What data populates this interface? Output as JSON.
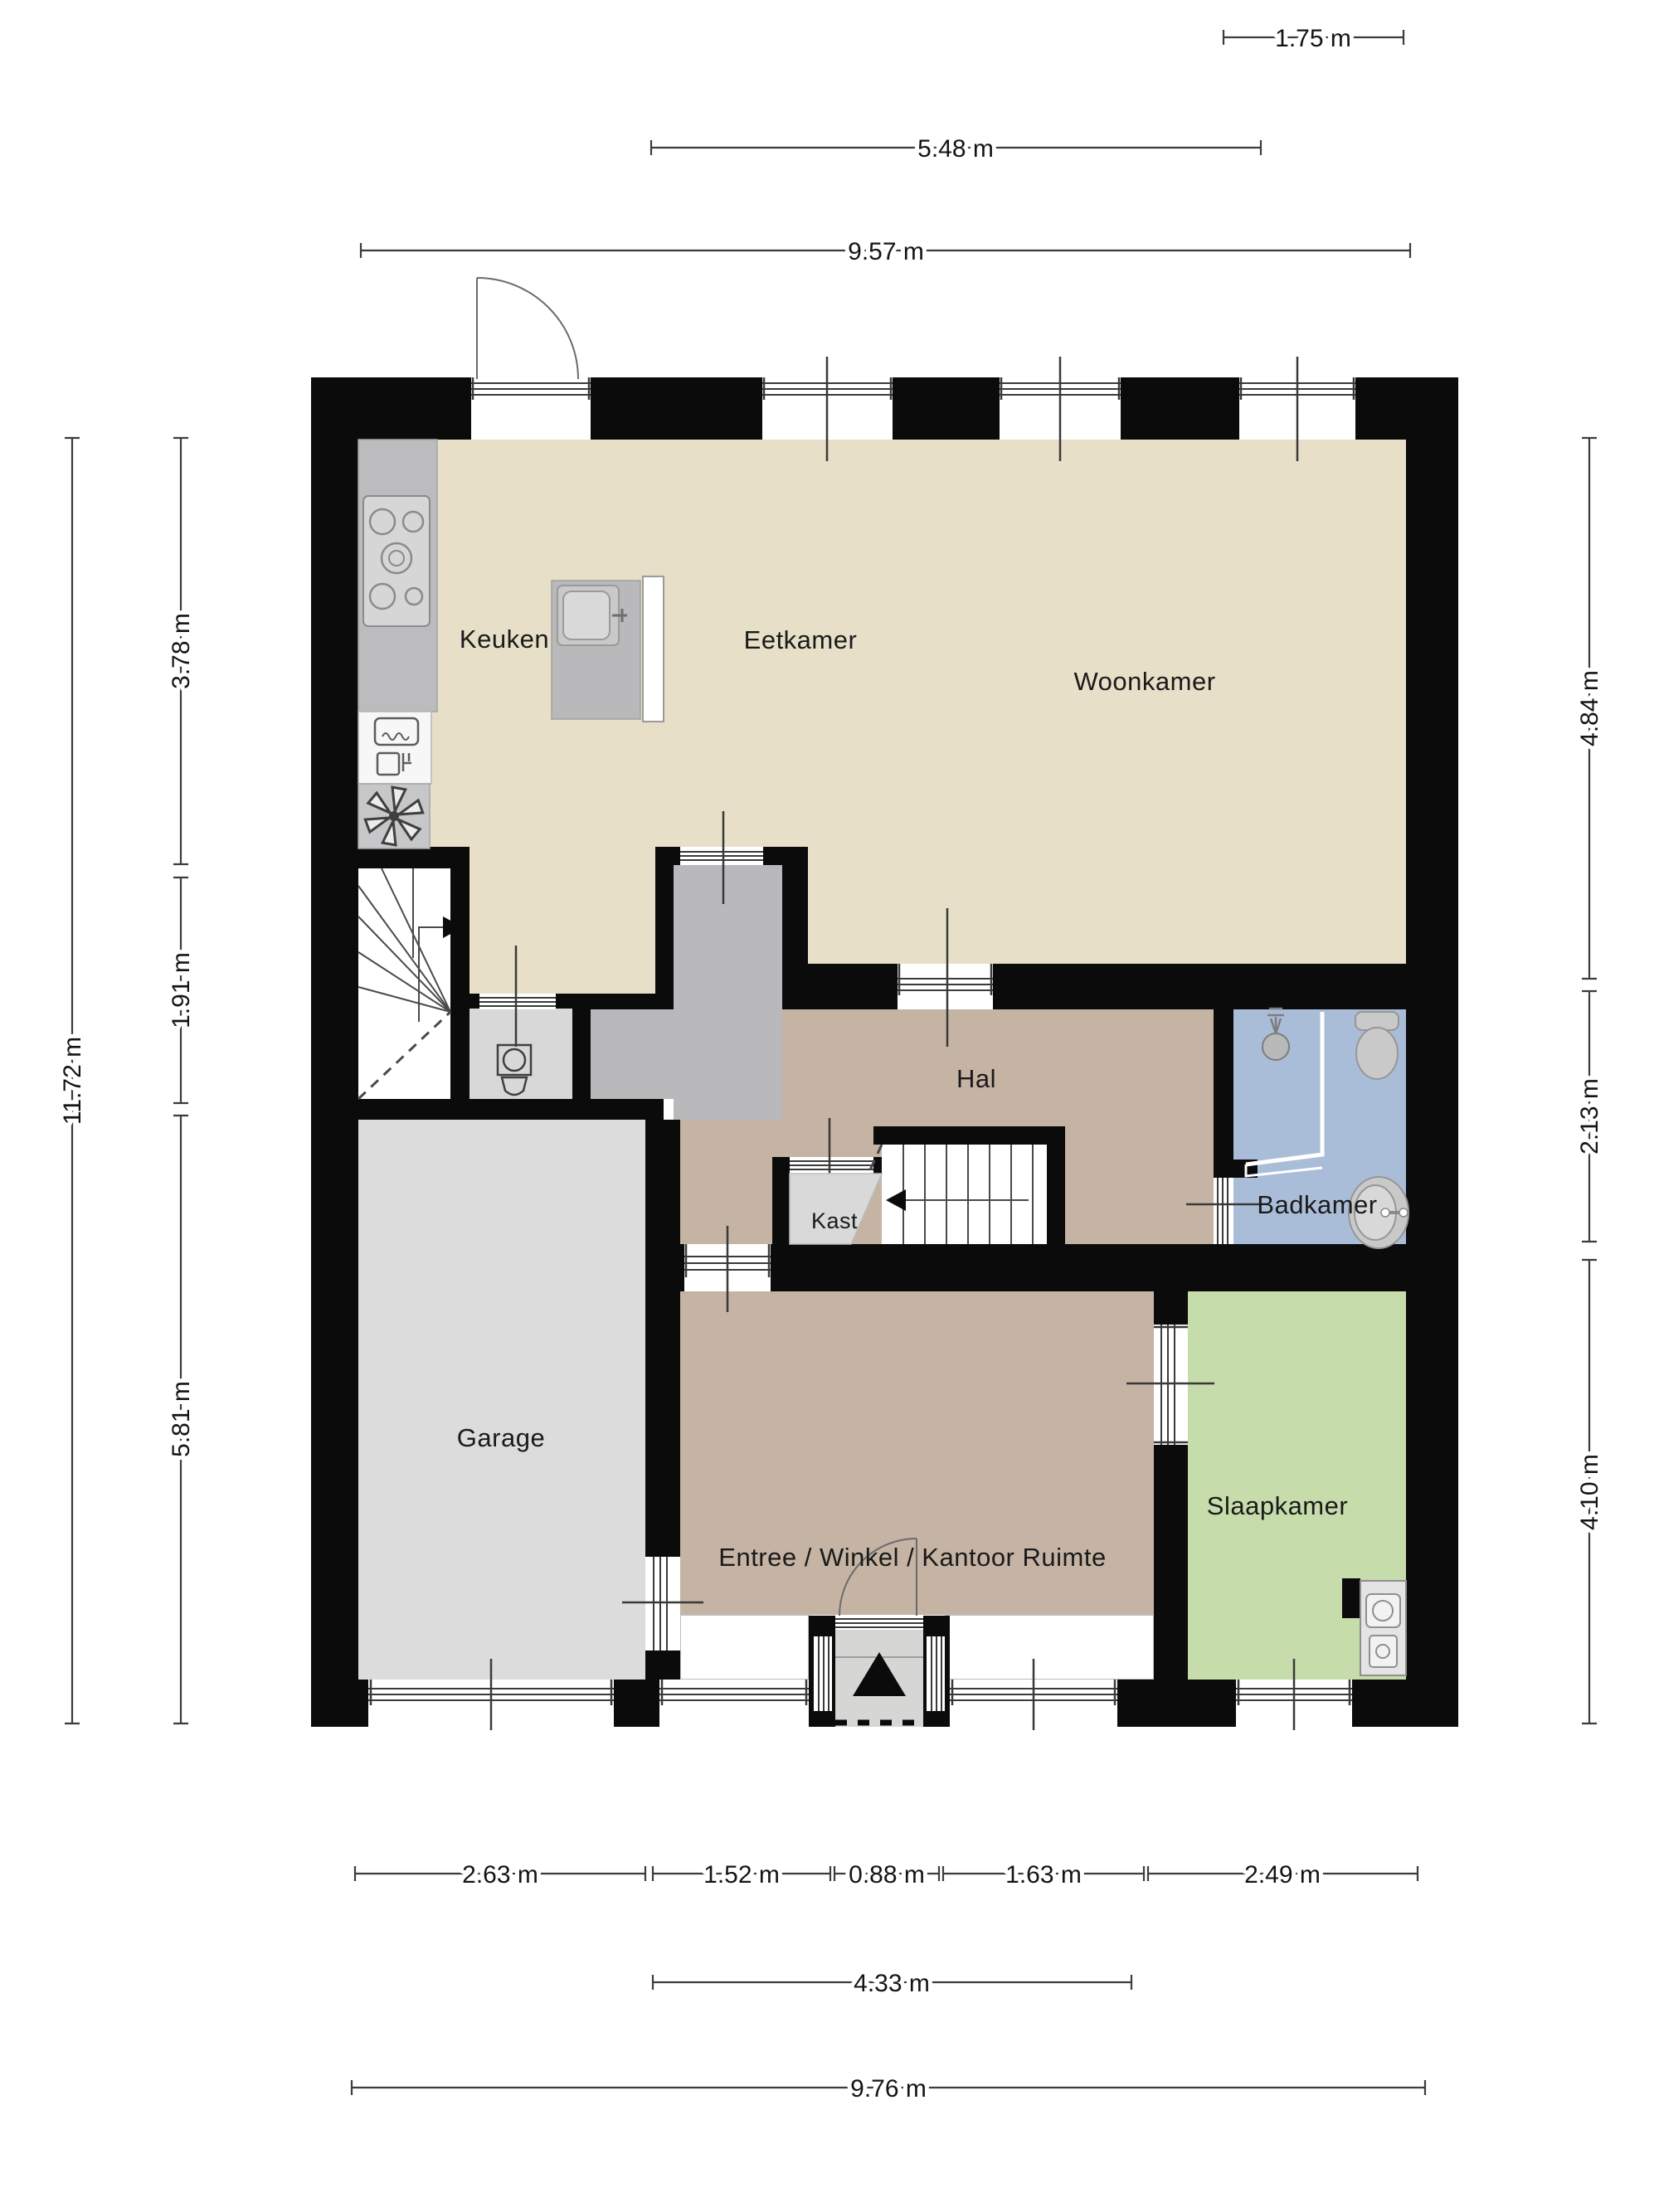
{
  "floorplan": {
    "title": "Begane grond plattegrond",
    "rooms": {
      "keuken": {
        "label": "Keuken"
      },
      "eetkamer": {
        "label": "Eetkamer"
      },
      "woonkamer": {
        "label": "Woonkamer"
      },
      "hal": {
        "label": "Hal"
      },
      "kast": {
        "label": "Kast"
      },
      "badkamer": {
        "label": "Badkamer"
      },
      "garage": {
        "label": "Garage"
      },
      "entree": {
        "label": "Entree /  Winkel / Kantoor Ruimte"
      },
      "slaapkamer": {
        "label": "Slaapkamer"
      }
    },
    "dimensions": {
      "top": [
        "1.75 m",
        "5.48 m",
        "9.57 m"
      ],
      "left": [
        "11.72 m",
        "3.78 m",
        "1.91 m",
        "5.81 m"
      ],
      "right": [
        "4.84 m",
        "2.13 m",
        "4.10 m"
      ],
      "bottom": [
        "2.63 m",
        "1.52 m",
        "0.88 m",
        "1.63 m",
        "2.49 m",
        "4.33 m",
        "9.76 m"
      ]
    },
    "icons": [
      "stove-icon",
      "oven-icon",
      "dishwasher-icon",
      "extractor-fan-icon",
      "sink-icon",
      "toilet-icon",
      "shower-icon",
      "washbasin-icon",
      "stairs-up-arrow-icon",
      "entrance-arrow-icon"
    ],
    "colors": {
      "wall": "#0b0b0b",
      "floor_living": "#e7dfc7",
      "floor_hall": "#c5b3a3",
      "floor_garage": "#dcdcdc",
      "floor_bath": "#aabdd8",
      "floor_bedroom": "#c6dcab",
      "floor_corridor": "#b9b9bc",
      "counter": "#bcbcbe",
      "dimension_line": "#3c3c3c",
      "label_text": "#1a1a1a"
    }
  }
}
